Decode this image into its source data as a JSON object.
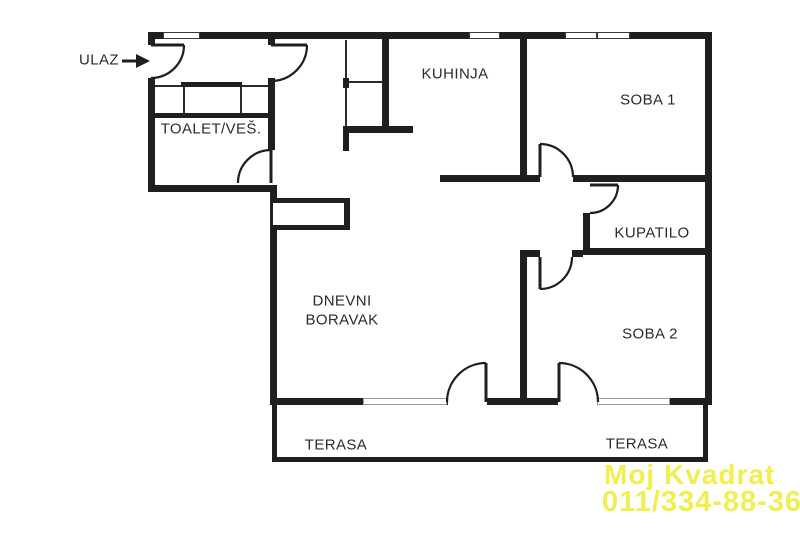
{
  "floor_plan": {
    "entrance": {
      "label": "ULAZ"
    },
    "rooms": {
      "toalet": {
        "label": "TOALET/VEŠ."
      },
      "kuhinja": {
        "label": "KUHINJA"
      },
      "soba1": {
        "label": "SOBA 1"
      },
      "kupatilo": {
        "label": "KUPATILO"
      },
      "dnevni": {
        "label_line1": "DNEVNI",
        "label_line2": "BORAVAK"
      },
      "soba2": {
        "label": "SOBA 2"
      },
      "terasa_left": {
        "label": "TERASA"
      },
      "terasa_right": {
        "label": "TERASA"
      }
    },
    "watermark": {
      "line1": "Moj Kvadrat",
      "line2": "011/334-88-36",
      "color": "#f1ef50"
    },
    "colors": {
      "wall": "#1f1f1f",
      "background": "#ffffff",
      "text": "#2b2b2b"
    }
  }
}
